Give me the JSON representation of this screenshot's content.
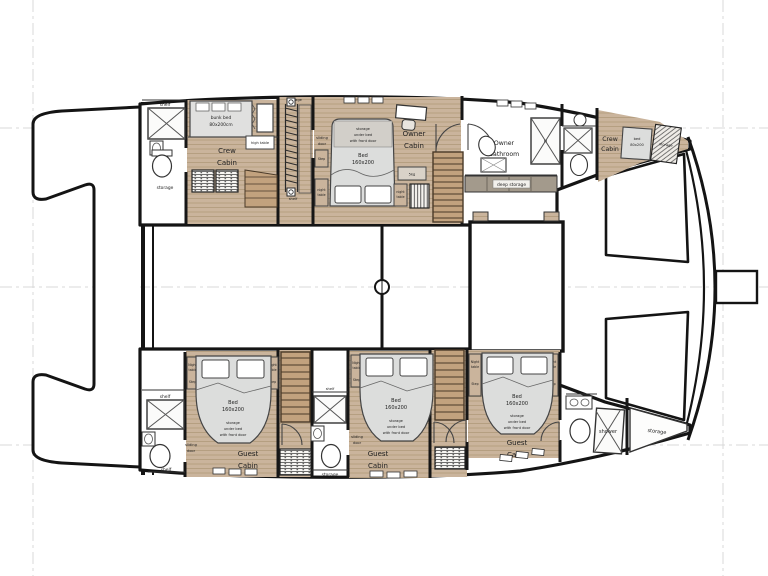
{
  "colors": {
    "wood": "#cab49c",
    "wood_line": "#a8916f",
    "stair_wood": "#c2a27e",
    "stair_line": "#4a3a28",
    "mattress": "#dcdddc",
    "storage_strip": "#a39a8c",
    "wall": "#141414",
    "guide": "#d6d6d6",
    "text": "#222222"
  },
  "boat": {
    "crew_cabin_aft": {
      "name1": "Crew",
      "name2": "Cabin",
      "bunk1": "bunk bed",
      "bunk2": "80x200cm",
      "high_table": "high table"
    },
    "aft_stairwell": {
      "storage": "storage",
      "shelf": "shelf"
    },
    "owner_cabin": {
      "name1": "Owner",
      "name2": "Cabin",
      "bed1": "Bed",
      "bed2": "160x200",
      "under1": "storage",
      "under2": "under bed",
      "under3": "with front door",
      "step": "Step",
      "night1": "night",
      "night2": "table",
      "washer": "5kg",
      "sliding1": "sliding",
      "sliding2": "door"
    },
    "owner_bathroom": {
      "name1": "Owner",
      "name2": "Bathroom",
      "deep_storage": "deep storage"
    },
    "crew_cabin_bow": {
      "name1": "Crew",
      "name2": "Cabin",
      "bed1": "bed",
      "bed2": "80x200",
      "storage": "storage"
    },
    "guest_cabin": {
      "name1": "Guest",
      "name2": "Cabin",
      "bed1": "Bed",
      "bed2": "160x200",
      "under1": "storage",
      "under2": "under bed",
      "under3": "with front door",
      "night1": "Night",
      "night2": "table",
      "step": "Step",
      "sliding1": "sliding",
      "sliding2": "door"
    },
    "bathroom": {
      "shelf": "shelf",
      "storage": "storage",
      "shower": "shower"
    },
    "bow_storage": "storage"
  }
}
